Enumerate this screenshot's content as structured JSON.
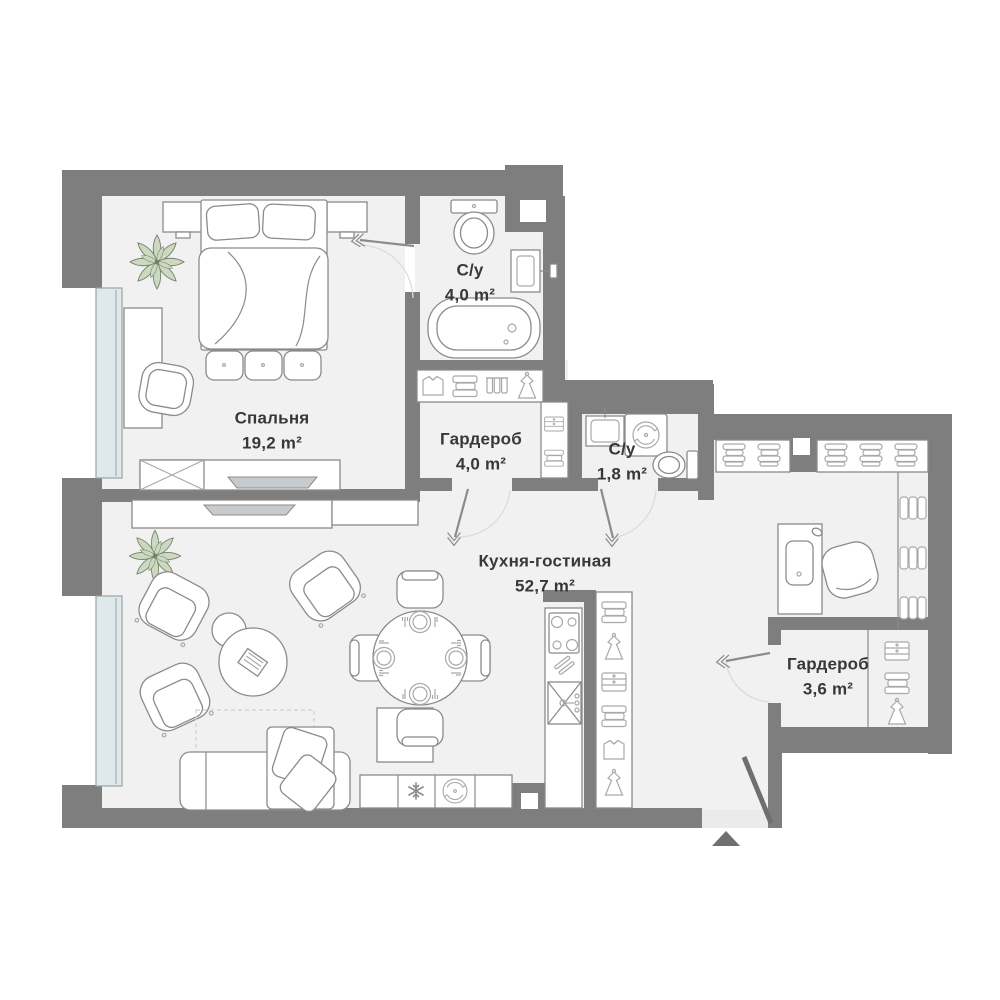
{
  "plan": {
    "rooms": [
      {
        "id": "bedroom",
        "name": "Спальня",
        "area": "19,2 m²"
      },
      {
        "id": "bathroom-main",
        "name": "С/у",
        "area": "4,0 m²"
      },
      {
        "id": "wardrobe-main",
        "name": "Гардероб",
        "area": "4,0 m²"
      },
      {
        "id": "bathroom-small",
        "name": "С/у",
        "area": "1,8 m²"
      },
      {
        "id": "kitchen-living",
        "name": "Кухня-гостиная",
        "area": "52,7 m²"
      },
      {
        "id": "wardrobe-hall",
        "name": "Гардероб",
        "area": "3,6 m²"
      }
    ],
    "colors": {
      "wall": "#7e7e7e",
      "floor": "#f1f1f2",
      "window": "#dfe9ec",
      "winframe": "#9aa4a8",
      "stroke": "#8b8b8b",
      "icon": "#a9a9a9",
      "tv": "#c7cbce",
      "plantfill": "#ccd8c0",
      "plantstroke": "#72806a",
      "text": "#383838",
      "arc": "#dcdcdc",
      "entry": "#6f6f6f"
    },
    "icons": [
      "bed",
      "pillow",
      "plant",
      "bathtub",
      "toilet",
      "washbasin",
      "washing-machine",
      "stove",
      "kitchen-sink",
      "utensils",
      "fridge-snowflake",
      "sofa",
      "armchair",
      "coffee-table",
      "dining-table",
      "dining-chair",
      "plate-setting",
      "desk",
      "office-chair",
      "tv",
      "radiator",
      "book-stack",
      "clothes-shirt",
      "clothes-stack",
      "clothes-rail",
      "dress",
      "drawers",
      "door-swing",
      "entrance-arrow"
    ]
  }
}
